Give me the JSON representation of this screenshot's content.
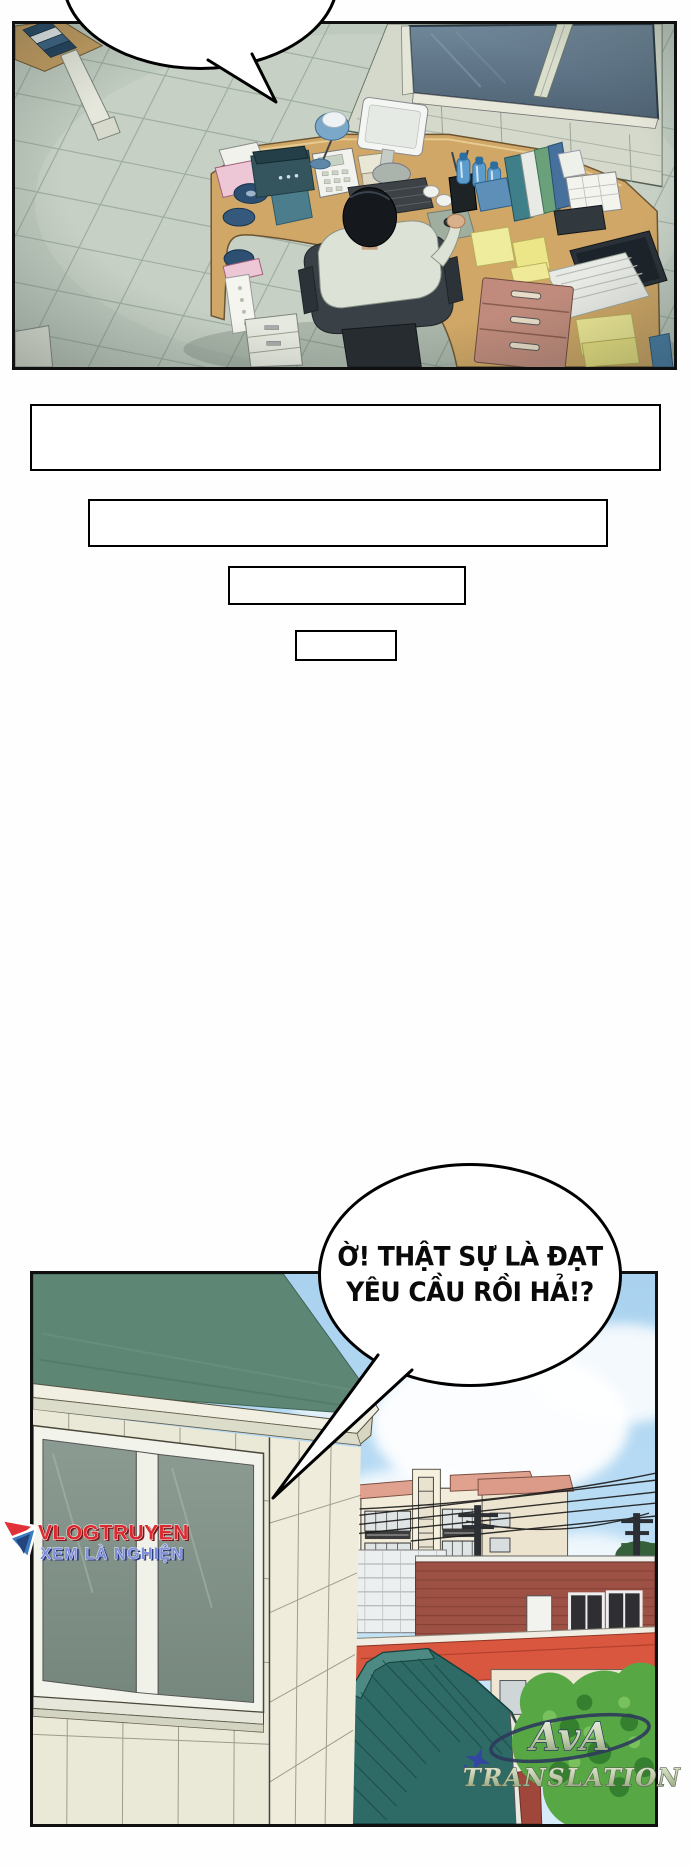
{
  "comic": {
    "bubble_top": {
      "text": ""
    },
    "bubble_bottom": {
      "line1": "Ờ! THẬT SỰ LÀ ĐẠT",
      "line2": "YÊU CẦU RỒI HẢ!?"
    },
    "narration_boxes": [
      "",
      "",
      "",
      ""
    ],
    "watermark_site": {
      "line1": "VLOGTRUYEN",
      "line2": "XEM LÀ NGHIỆN",
      "color_line1": "#d92b30",
      "color_line2": "#8090d8"
    },
    "watermark_group": {
      "line1": "AvA",
      "line2": "TRANSLATION",
      "outline_color": "#2e3a5c",
      "fill_color": "#b9c6a2"
    },
    "colors": {
      "page_background": "#fefefe",
      "panel_border": "#101010",
      "office_floor": "#bfcabf",
      "office_wall_window": "#5a7082",
      "desk_wood": "#d0a766",
      "drawer_unit": "#c08b7c",
      "house_roof_green": "#5d8674",
      "house_wall": "#eae9d8",
      "sky_blue": "#a9d2ef",
      "city_roof_red": "#d8573e",
      "brick_red": "#9d5044",
      "hanok_roof_teal": "#2e6a66",
      "tree_green": "#57a845",
      "notepad_yellow": "#efe996"
    }
  }
}
